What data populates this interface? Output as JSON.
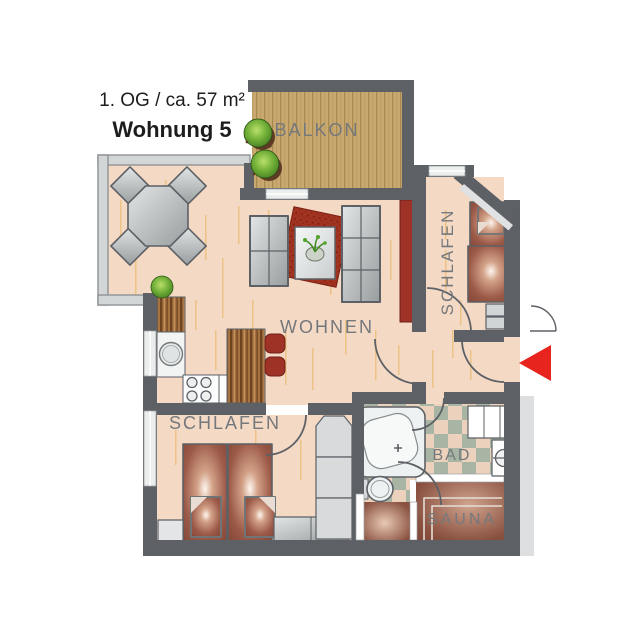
{
  "title": {
    "line1": "1. OG / ca. 57 m²",
    "line2": "Wohnung 5"
  },
  "rooms": {
    "balkon": "BALKON",
    "schlafen_top": "SCHLAFEN",
    "wohnen": "WOHNEN",
    "schlafen_bottom": "SCHLAFEN",
    "bad": "BAD",
    "sauna": "SAUNA"
  },
  "colors": {
    "wall": "#5d6166",
    "window_wall": "#d3d6d7",
    "floor_wood": "#f4d9c5",
    "floor_grain": "#ecbe7a",
    "balcony_deck": "#c9a96f",
    "tile_green": "#a9b5a4",
    "tile_peach": "#ecd2bc",
    "bed_maroon": "#7c4134",
    "accent_red": "#9e3227",
    "rug_red": "#a23320",
    "arrow_red": "#e8241f",
    "furniture_gray": "#aeb3b5",
    "label_gray": "#74787c"
  },
  "icons": {
    "entrance_arrow": "entrance-arrow-icon",
    "balcony_plants": "plant-icon",
    "floor_plant": "plant-icon"
  }
}
